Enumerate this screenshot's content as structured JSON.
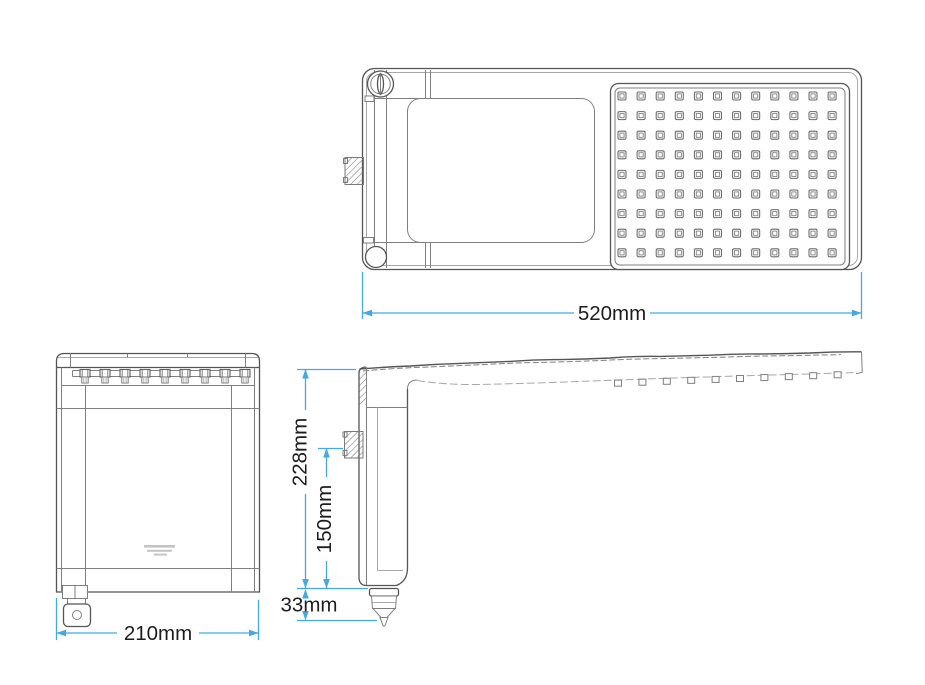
{
  "page": {
    "background": "#ffffff",
    "description": "Technical dimension drawing of an electric shower head shown in three orthographic views"
  },
  "dimensions": {
    "top_width": "520mm",
    "front_width": "210mm",
    "side_height_total": "228mm",
    "side_height_inlet": "150mm",
    "side_height_spout": "33mm"
  },
  "views": {
    "top": {
      "label": "top view",
      "nozzle_grid": {
        "columns": 12,
        "rows": 9
      }
    },
    "front": {
      "label": "front view",
      "clip_count": 9
    },
    "side": {
      "label": "side view",
      "nozzle_tip_count": 10
    }
  },
  "colors": {
    "dimension_line": "#45a9de",
    "dimension_text": "#1d1d1d",
    "line_dark": "#555555",
    "line_mid": "#7f7f7f",
    "line_light": "#a8a8a8",
    "logo_gray": "#c4c4c4"
  }
}
